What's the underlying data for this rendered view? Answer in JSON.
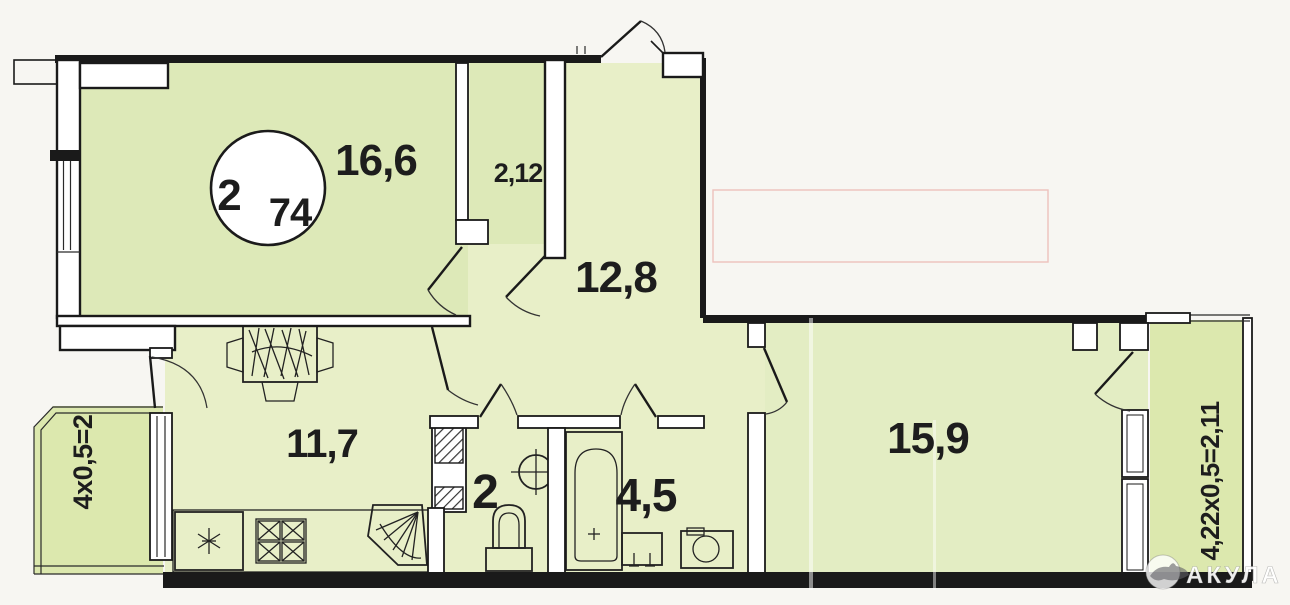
{
  "plan": {
    "title_badge": {
      "rooms_count": "2",
      "total_area": "74"
    },
    "rooms": [
      {
        "id": "living-room",
        "label": "16,6"
      },
      {
        "id": "wardrobe",
        "label": "2,12"
      },
      {
        "id": "hallway",
        "label": "12,8"
      },
      {
        "id": "kitchen",
        "label": "11,7"
      },
      {
        "id": "wc",
        "label": "2"
      },
      {
        "id": "bathroom",
        "label": "4,5"
      },
      {
        "id": "bedroom",
        "label": "15,9"
      }
    ],
    "balconies": [
      {
        "id": "left-balcony",
        "label": "4х0,5=2"
      },
      {
        "id": "right-balcony",
        "label": "4,22х0,5=2,11"
      }
    ],
    "watermark": {
      "text": "АКУЛА"
    },
    "colors": {
      "wall": "#1a1a1a",
      "room_fill": "#dde9b8",
      "hall_fill": "#e8efc8",
      "bedroom_fill": "#e3edc3",
      "balcony_fill": "#dce8ae",
      "paper": "#f7f6f2"
    }
  }
}
